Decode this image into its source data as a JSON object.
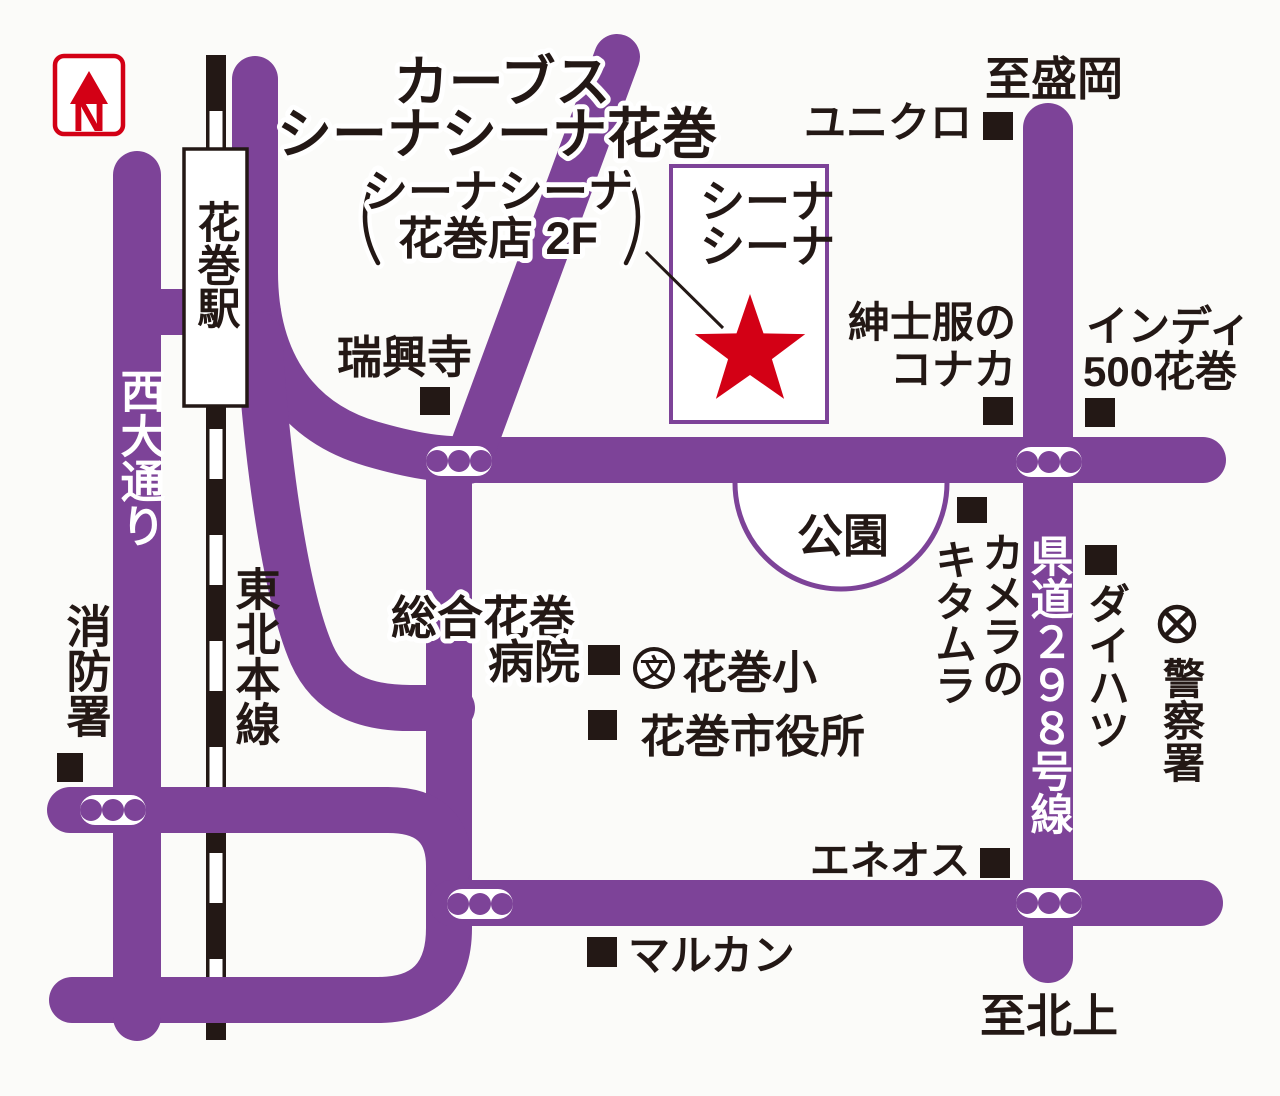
{
  "colors": {
    "road": "#7d4398",
    "red": "#d30015",
    "ink": "#231815"
  },
  "compass": {
    "n": "N"
  },
  "title": {
    "line1": "カーブス",
    "line2": "シーナシーナ花巻",
    "paren_line1": "シーナシーナ",
    "paren_line2": "花巻店 2F"
  },
  "destination": {
    "line1": "シーナ",
    "line2": "シーナ"
  },
  "edges": {
    "north": "至盛岡",
    "south": "至北上"
  },
  "roads": {
    "nishi_odori": "西大通り",
    "kendo_298": "県道２９８号線"
  },
  "railway": {
    "station": "花巻駅",
    "line_name": "東北本線"
  },
  "landmarks": {
    "uniqlo": "ユニクロ",
    "zuikoji": "瑞興寺",
    "konaka_line1": "紳士服の",
    "konaka_line2": "コナカ",
    "indy_line1": "インディ",
    "indy_line2": "500花巻",
    "park": "公園",
    "kitamura_line1": "カメラの",
    "kitamura_line2": "キタムラ",
    "daihatsu": "ダイハツ",
    "police": "警察署",
    "hospital_line1": "総合花巻",
    "hospital_line2": "病院",
    "school": "花巻小",
    "school_symbol": "文",
    "city_hall": "花巻市役所",
    "fire_station": "消防署",
    "eneos": "エネオス",
    "marukan": "マルカン"
  }
}
